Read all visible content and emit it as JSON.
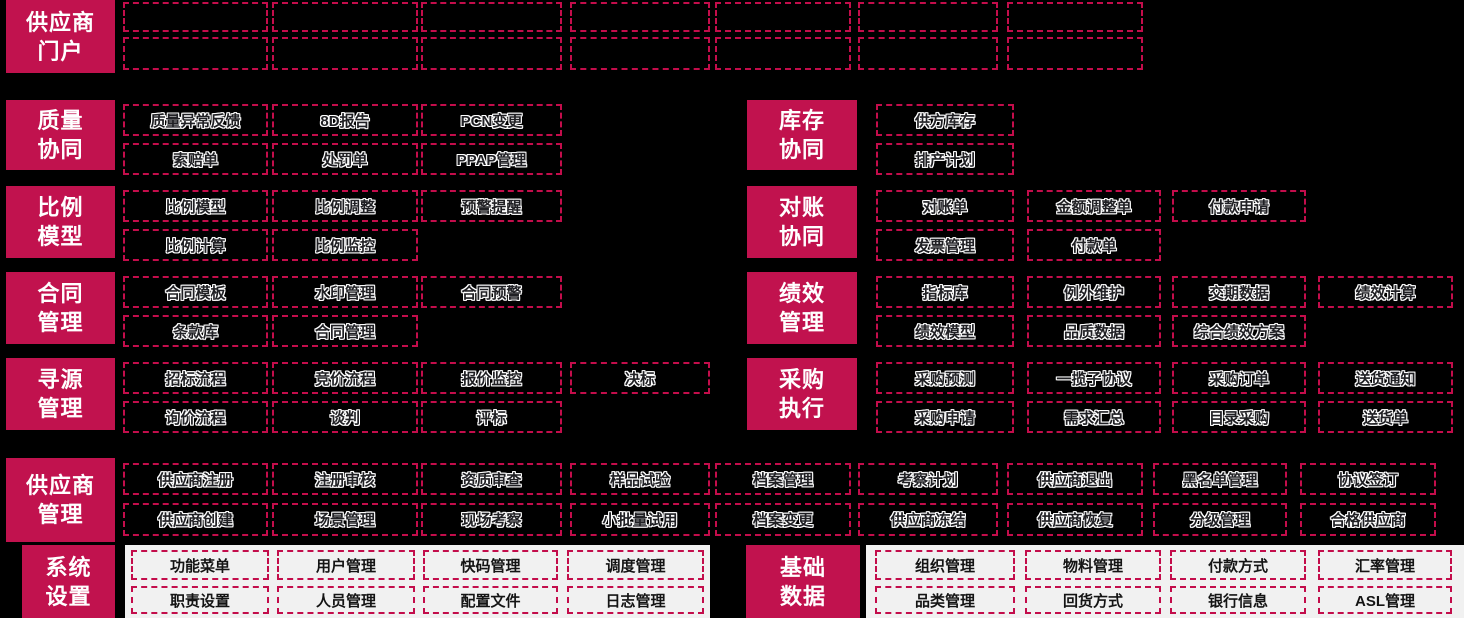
{
  "colors": {
    "background": "#000000",
    "accent": "#C1124E",
    "dashed_border": "#C30D4B",
    "bottom_panel": "#F1F1F1",
    "box_text": "#202024",
    "label_text": "#FFFFFF"
  },
  "sections": {
    "portal": {
      "label1": "供应商",
      "label2": "门户"
    },
    "quality": {
      "label1": "质量",
      "label2": "协同",
      "row1": [
        "质量异常反馈",
        "8D报告",
        "PCN变更"
      ],
      "row2": [
        "索赔单",
        "处罚单",
        "PPAP管理"
      ]
    },
    "inventory": {
      "label1": "库存",
      "label2": "协同",
      "row1": [
        "供方库存"
      ],
      "row2": [
        "排产计划"
      ]
    },
    "ratio": {
      "label1": "比例",
      "label2": "模型",
      "row1": [
        "比例模型",
        "比例调整",
        "预警提醒"
      ],
      "row2": [
        "比例计算",
        "比例监控"
      ]
    },
    "recon": {
      "label1": "对账",
      "label2": "协同",
      "row1": [
        "对账单",
        "金额调整单",
        "付款申请"
      ],
      "row2": [
        "发票管理",
        "付款单"
      ]
    },
    "contract": {
      "label1": "合同",
      "label2": "管理",
      "row1": [
        "合同模板",
        "水印管理",
        "合同预警"
      ],
      "row2": [
        "条款库",
        "合同管理"
      ]
    },
    "perf": {
      "label1": "绩效",
      "label2": "管理",
      "row1": [
        "指标库",
        "例外维护",
        "交期数据",
        "绩效计算"
      ],
      "row2": [
        "绩效模型",
        "品质数据",
        "综合绩效方案"
      ]
    },
    "sourcing": {
      "label1": "寻源",
      "label2": "管理",
      "row1": [
        "招标流程",
        "竞价流程",
        "报价监控",
        "决标"
      ],
      "row2": [
        "询价流程",
        "谈判",
        "评标"
      ]
    },
    "execution": {
      "label1": "采购",
      "label2": "执行",
      "row1": [
        "采购预测",
        "一揽子协议",
        "采购订单",
        "送货通知"
      ],
      "row2": [
        "采购申请",
        "需求汇总",
        "目录采购",
        "送货单"
      ]
    },
    "supplier": {
      "label1": "供应商",
      "label2": "管理",
      "row1": [
        "供应商注册",
        "注册审核",
        "资质审查",
        "样品试验",
        "档案管理",
        "考察计划",
        "供应商退出",
        "黑名单管理",
        "协议签订"
      ],
      "row2": [
        "供应商创建",
        "场景管理",
        "现场考察",
        "小批量试用",
        "档案变更",
        "供应商冻结",
        "供应商恢复",
        "分级管理",
        "合格供应商"
      ]
    },
    "system": {
      "label1": "系统",
      "label2": "设置",
      "row1": [
        "功能菜单",
        "用户管理",
        "快码管理",
        "调度管理"
      ],
      "row2": [
        "职责设置",
        "人员管理",
        "配置文件",
        "日志管理"
      ]
    },
    "basic": {
      "label1": "基础",
      "label2": "数据",
      "row1": [
        "组织管理",
        "物料管理",
        "付款方式",
        "汇率管理"
      ],
      "row2": [
        "品类管理",
        "回货方式",
        "银行信息",
        "ASL管理"
      ]
    }
  }
}
